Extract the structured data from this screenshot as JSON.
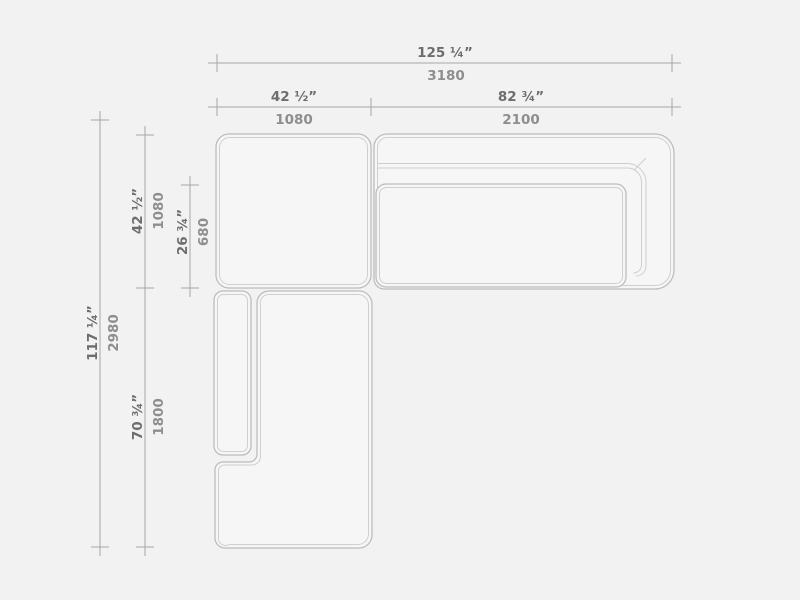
{
  "palette": {
    "background": "#f2f2f2",
    "module_fill": "#f6f6f6",
    "outline_outer": "#bdbdbd",
    "outline_inner": "#cfcfcf",
    "dimension_line": "#a6a6a6",
    "inches_text_color": "#6d6d6d",
    "mm_text_color": "#8e8e8e"
  },
  "dimensions": {
    "overall_width": {
      "inches": "125 ¼”",
      "mm": "3180"
    },
    "corner_module_width": {
      "inches": "42 ½”",
      "mm": "1080"
    },
    "sofa_module_width": {
      "inches": "82 ¾”",
      "mm": "2100"
    },
    "overall_depth": {
      "inches": "117 ¼”",
      "mm": "2980"
    },
    "corner_module_depth": {
      "inches": "42 ½”",
      "mm": "1080"
    },
    "seat_depth": {
      "inches": "26 ¾”",
      "mm": "680"
    },
    "chaise_module_length": {
      "inches": "70 ¾”",
      "mm": "1800"
    }
  }
}
